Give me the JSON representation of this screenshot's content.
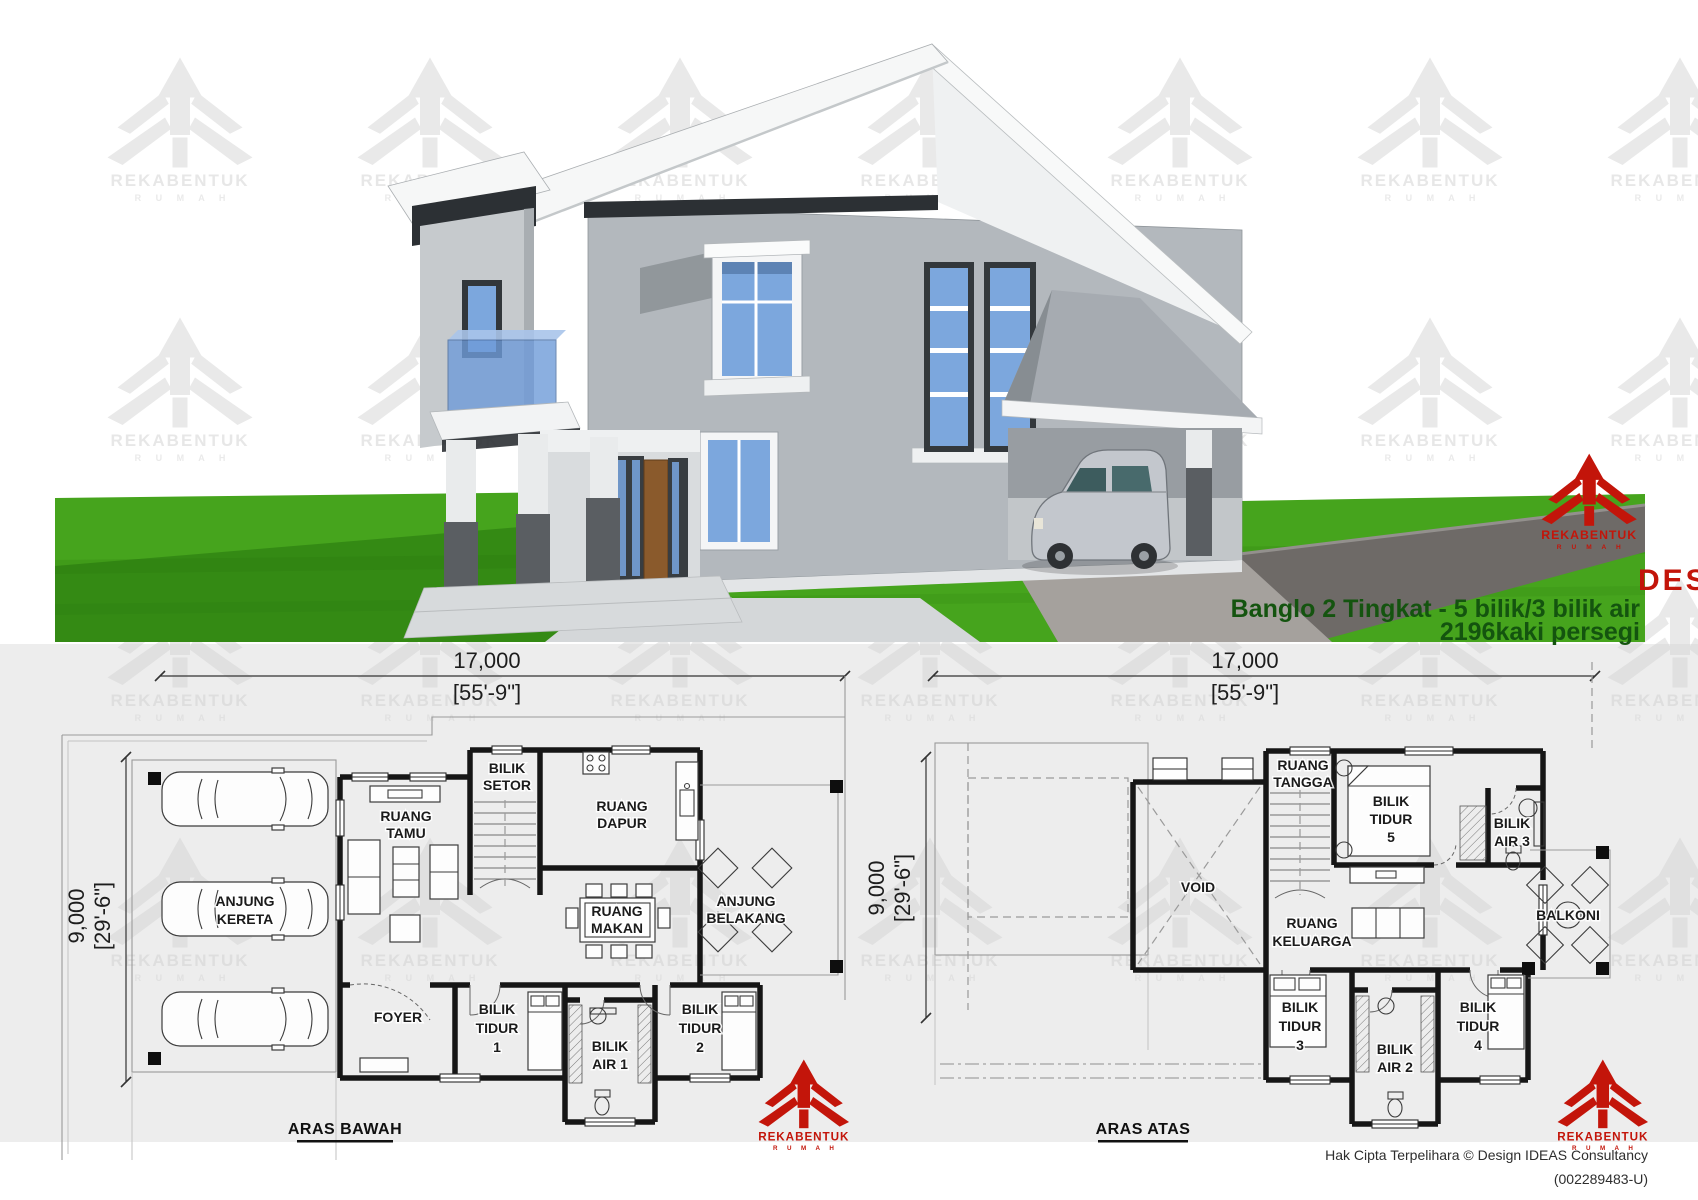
{
  "render": {
    "design_label": "DESIGN",
    "design_code": "D248",
    "subtitle": "Banglo 2 Tingkat - 5 bilik/3 bilik air",
    "area_text": "2196kaki persegi",
    "colors": {
      "accent_red": "#c3150a",
      "title_green": "#14540f",
      "grass": "#46a41d",
      "road": "#6e6a67",
      "wall_gray": "#b3b8bd",
      "trim_dark": "#2c3034",
      "window_blue": "#7ca7dd"
    }
  },
  "brand": {
    "name": "REKABENTUK",
    "sub": "R U M A H"
  },
  "plans": {
    "ground": {
      "title": "ARAS BAWAH",
      "width_mm": "17,000",
      "width_ft": "[55'-9\"]",
      "depth_mm": "9,000",
      "depth_ft": "[29'-6\"]",
      "rooms": {
        "anjung_kereta": [
          "ANJUNG",
          "KERETA"
        ],
        "ruang_tamu": [
          "RUANG",
          "TAMU"
        ],
        "bilik_setor": [
          "BILIK",
          "SETOR"
        ],
        "ruang_dapur": [
          "RUANG",
          "DAPUR"
        ],
        "ruang_makan": [
          "RUANG",
          "MAKAN"
        ],
        "anjung_belakang": [
          "ANJUNG",
          "BELAKANG"
        ],
        "foyer": [
          "FOYER"
        ],
        "bilik_tidur_1": [
          "BILIK",
          "TIDUR",
          "1"
        ],
        "bilik_air_1": [
          "BILIK",
          "AIR 1"
        ],
        "bilik_tidur_2": [
          "BILIK",
          "TIDUR",
          "2"
        ]
      }
    },
    "upper": {
      "title": "ARAS ATAS",
      "width_mm": "17,000",
      "width_ft": "[55'-9\"]",
      "depth_mm": "9,000",
      "depth_ft": "[29'-6\"]",
      "rooms": {
        "void": [
          "VOID"
        ],
        "ruang_tangga": [
          "RUANG",
          "TANGGA"
        ],
        "bilik_tidur_5": [
          "BILIK",
          "TIDUR",
          "5"
        ],
        "bilik_air_3": [
          "BILIK",
          "AIR 3"
        ],
        "ruang_keluarga": [
          "RUANG",
          "KELUARGA"
        ],
        "balkoni": [
          "BALKONI"
        ],
        "bilik_tidur_3": [
          "BILIK",
          "TIDUR",
          "3"
        ],
        "bilik_air_2": [
          "BILIK",
          "AIR 2"
        ],
        "bilik_tidur_4": [
          "BILIK",
          "TIDUR",
          "4"
        ]
      }
    }
  },
  "footer": {
    "line1": "Hak Cipta Terpelihara  © Design IDEAS Consultancy",
    "line2": "(002289483-U)"
  }
}
